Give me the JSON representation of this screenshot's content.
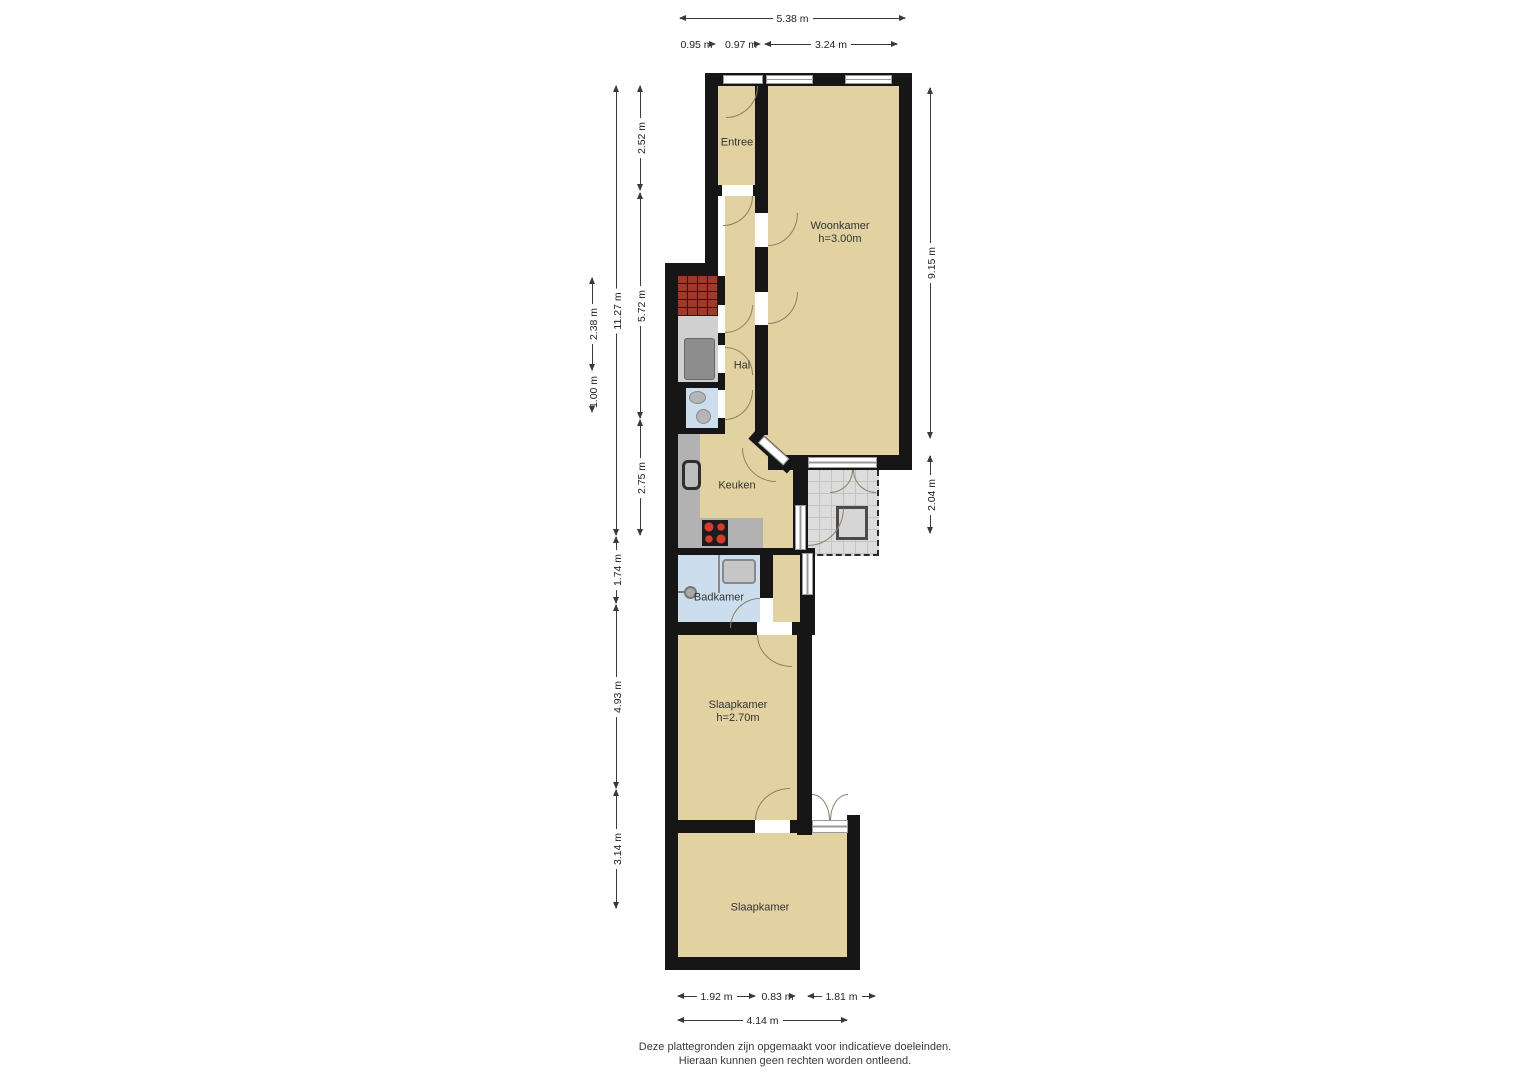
{
  "plan_type": "floor-plan",
  "rooms": {
    "entree": {
      "name": "Entree"
    },
    "woonkamer": {
      "name": "Woonkamer",
      "ceiling": "h=3.00m"
    },
    "hal": {
      "name": "Hal"
    },
    "keuken": {
      "name": "Keuken"
    },
    "badkamer": {
      "name": "Badkamer"
    },
    "slaapkamer_1": {
      "name": "Slaapkamer",
      "ceiling": "h=2.70m"
    },
    "slaapkamer_2": {
      "name": "Slaapkamer"
    }
  },
  "dimensions": {
    "top": [
      "5.38 m",
      "0.95 m",
      "0.97 m",
      "3.24 m"
    ],
    "left": [
      "2.52 m",
      "5.72 m",
      "2.75 m",
      "11.27 m",
      "1.74 m",
      "4.93 m",
      "3.14 m",
      "2.38 m",
      "1.00 m"
    ],
    "right": [
      "9.15 m",
      "2.04 m"
    ],
    "bottom": [
      "1.92 m",
      "0.83 m",
      "1.81 m",
      "4.14 m"
    ]
  },
  "footer": {
    "line1": "Deze plattegronden zijn opgemaakt voor indicatieve doeleinden.",
    "line2": "Hieraan kunnen geen rechten worden ontleend."
  },
  "colors": {
    "floor": "#e2d2a2",
    "wall": "#161616",
    "bathroom_floor": "#ccdeee",
    "balcony": "#dcdcdc",
    "roof_tiles": "#9c3c28",
    "counter": "#b2b2b2",
    "burner_red": "#d43a2e"
  }
}
